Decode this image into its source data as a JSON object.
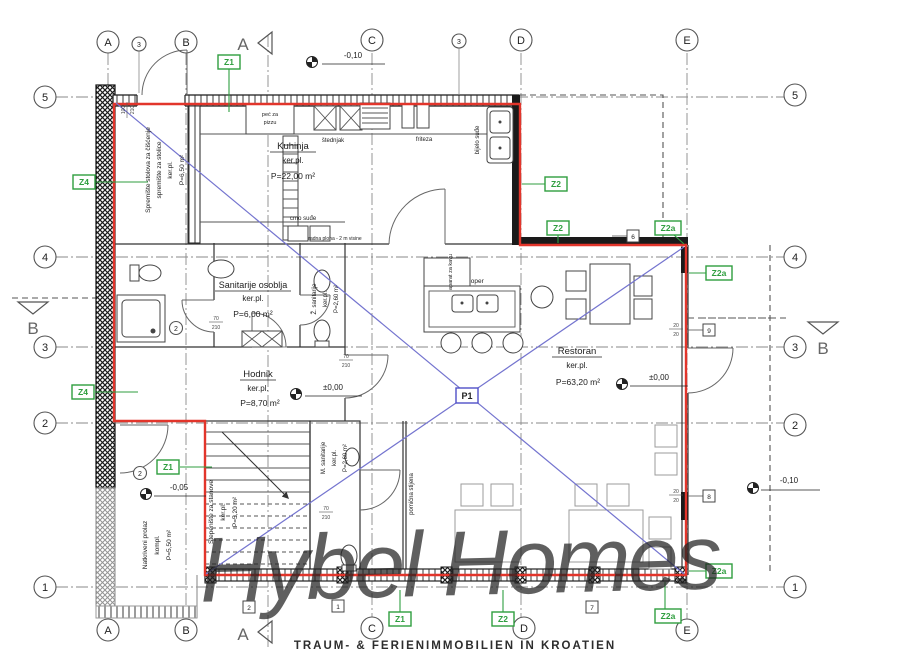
{
  "watermark": {
    "script": "Hybel Homes",
    "tagline": "TRAUM- & FERIENIMMOBILIEN IN KROATIEN"
  },
  "grid": {
    "cols": [
      "A",
      "B",
      "C",
      "D",
      "E"
    ],
    "rows": [
      "5",
      "4",
      "3",
      "2",
      "1"
    ]
  },
  "sections": {
    "a": "A",
    "b": "B"
  },
  "zones": {
    "z1": "Z1",
    "z2": "Z2",
    "z4": "Z4",
    "z2a": "Z2a",
    "p1": "P1"
  },
  "elevations": {
    "top": "-0,10",
    "hodnik": "±0,00",
    "restoran": "±0,00",
    "prolaz": "-0,05",
    "terasa": "-0,10"
  },
  "rooms": {
    "kuhinja": {
      "name": "Kuhinja",
      "finish": "ker.pl.",
      "area": "P=22,00 m²"
    },
    "sanitarije_osoblja": {
      "name": "Sanitarije osoblja",
      "finish": "ker.pl.",
      "area": "P=6,00 m²"
    },
    "hodnik": {
      "name": "Hodnik",
      "finish": "ker.pl.",
      "area": "P=8,70 m²"
    },
    "restoran": {
      "name": "Restoran",
      "finish": "ker.pl.",
      "area": "P=63,20 m²"
    },
    "spremiste": {
      "line1": "Spremište stolova za čišćenje",
      "line2": "spremište za stolice",
      "finish": "ker.pl.",
      "area": "P=6,50 m²"
    },
    "stepeniste": {
      "name": "Stepenište za stanove",
      "finish": "ker.pl.",
      "area": "P=5,20 m²"
    },
    "natkriveni_prolaz": {
      "name": "Natkriveni prolaz",
      "finish": "kompl.",
      "area": "P=5,50 m²"
    },
    "m_sanitarije": {
      "name": "M. sanitarije",
      "finish": "ker.pl.",
      "area": "P=2,60 m²"
    },
    "z_sanitarije": {
      "name": "Ž. sanitarije",
      "finish": "ker.pl.",
      "area": "P=2,60 m²"
    }
  },
  "kitchen": {
    "pec_line1": "peć za",
    "pec_line2": "pizzu",
    "stednjak": "štednjak",
    "friteza": "friteza",
    "bijelo_sude": "bijelo suđe",
    "crno_sude": "crno suđe",
    "sudoper": "sudoper",
    "aparat": "aparat za kavu",
    "note": "radna ploha - 2 m visine"
  },
  "annotations": {
    "pomicna": "pomična stijena"
  },
  "ref_boxes": {
    "b6": "6",
    "b9": "9",
    "b8": "8",
    "b1": "1",
    "b7": "7",
    "b2": "2"
  },
  "balloons": {
    "top_left": "3",
    "top_mid": "3"
  },
  "door_tags": {
    "t1": "2",
    "t2": "2"
  },
  "dims": {
    "d100": "100",
    "d210": "210",
    "d70": "70",
    "d20": "20"
  },
  "colors": {
    "red": "#e2352b",
    "green": "#2f9e3f",
    "blue": "#7474cf",
    "p1_blue": "#5050c8",
    "watermark_script": "#c6cb7c",
    "watermark_tagline": "#c7a470"
  }
}
